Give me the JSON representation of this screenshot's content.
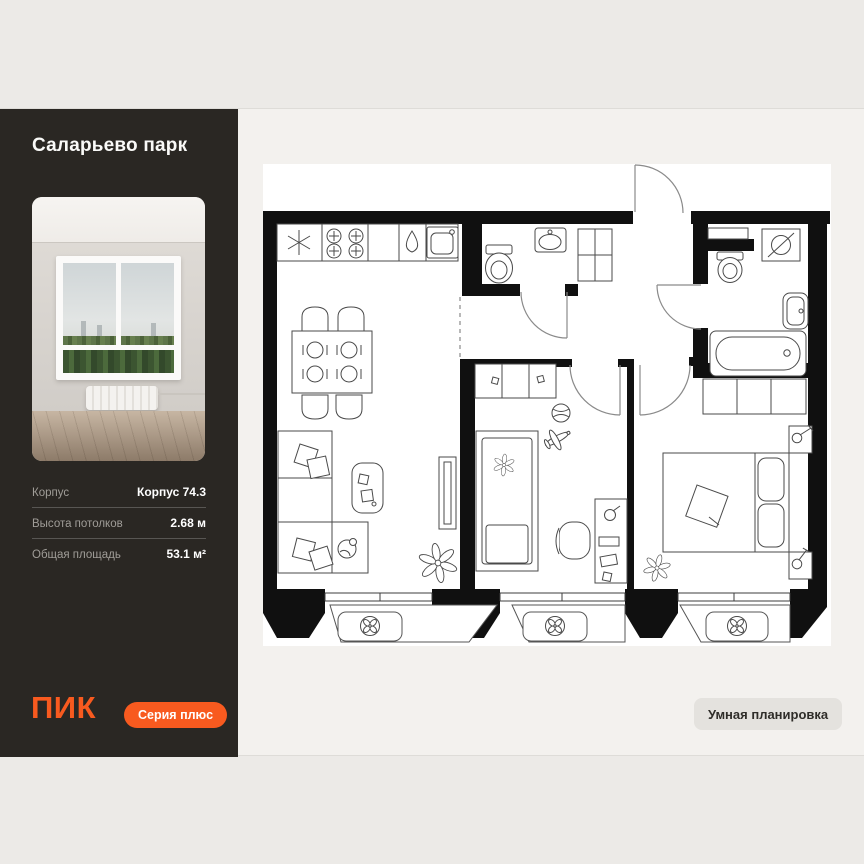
{
  "sidebar": {
    "title": "Саларьево парк",
    "specs": [
      {
        "label": "Корпус",
        "value": "Корпус 74.3"
      },
      {
        "label": "Высота потолков",
        "value": "2.68 м"
      },
      {
        "label": "Общая площадь",
        "value": "53.1 м²"
      }
    ],
    "logo": "ПИК",
    "series_badge": "Серия плюс"
  },
  "plan": {
    "smart_badge": "Умная планировка",
    "icons": [
      "fridge-icon",
      "stove-icon",
      "dishwasher-icon",
      "kitchen-sink-icon",
      "toilet-icon",
      "washbasin-icon",
      "washing-machine-icon",
      "bathtub-icon",
      "ac-fan-icon",
      "plant-icon",
      "dining-table",
      "sofa",
      "coffee-table",
      "tv",
      "single-bed",
      "double-bed",
      "wardrobe",
      "desk",
      "entrance-door"
    ]
  },
  "colors": {
    "accent": "#F85A1F",
    "sidebar_bg": "#2A2723",
    "page_bg": "#ECEAE7",
    "content_bg": "#F3F1EE",
    "smart_badge_bg": "#E4E2DE",
    "smart_badge_text": "#2F2D29",
    "wall": "#101010"
  }
}
